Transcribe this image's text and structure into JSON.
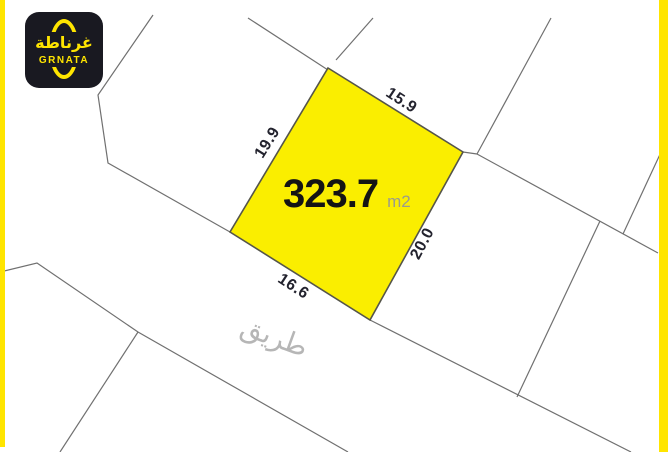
{
  "brand": {
    "logo_arabic": "غرناطة",
    "logo_latin": "GRNATA",
    "box_color": "#191921",
    "accent_yellow": "#FFE500"
  },
  "frame": {
    "left_border_color": "#FFE500",
    "right_border_color": "#FFE500"
  },
  "plot": {
    "area_value": "323.7",
    "area_unit": "m2",
    "fill": "#FAEE00",
    "outline_color": "#55554a",
    "dimensions": [
      {
        "side": "top",
        "value": "15.9"
      },
      {
        "side": "left",
        "value": "19.9"
      },
      {
        "side": "right",
        "value": "20.0"
      },
      {
        "side": "bottom",
        "value": "16.6"
      }
    ]
  },
  "road": {
    "label": "طريق",
    "label_color": "#b6b6b6"
  },
  "map": {
    "line_color": "#707070"
  }
}
